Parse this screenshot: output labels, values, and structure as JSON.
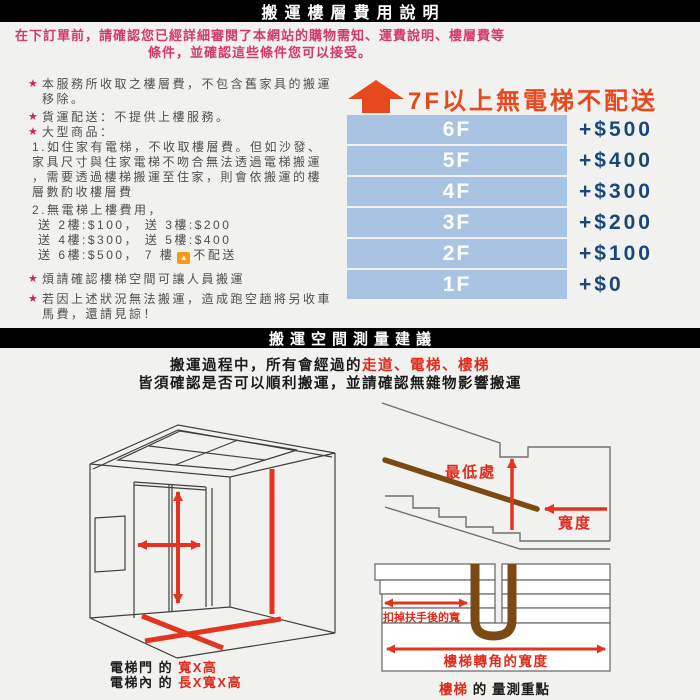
{
  "section1": {
    "header": "搬運樓層費用說明",
    "intro_line1": "在下訂單前，請確認您已經詳細審閱了本網站的購物需知、運費說明、樓層費等",
    "intro_line2": "條件，並確認這些條件您可以接受。",
    "bullet1": "本服務所收取之樓層費，不包含舊家具的搬運移除。",
    "bullet2": "貨運配送：不提供上樓服務。",
    "bullet3": "大型商品：",
    "bullet3_detail_lines": [
      "1.如住家有電梯，不收取樓層費。但如沙發、",
      "家具尺寸與住家電梯不吻合無法透過電梯搬運",
      "，需要透過樓梯搬運至住家，則會依搬運的樓",
      "層數酌收樓層費"
    ],
    "bullet3_detail2": "2.無電梯上樓費用，",
    "fee_line1": "送 2樓:$100， 送 3樓:$200",
    "fee_line2": "送 4樓:$300， 送 5樓:$400",
    "fee_line3_pre": "送 6樓:$500， 7 樓",
    "fee_line3_post": "不配送",
    "bullet4": "煩請確認樓梯空間可讓人員搬運",
    "bullet5": "若因上述狀況無法搬運，造成跑空趟將另收車馬費，還請見諒！",
    "warning": "7F以上無電梯不配送",
    "floors": [
      {
        "label": "6F",
        "fee": "+$500"
      },
      {
        "label": "5F",
        "fee": "+$400"
      },
      {
        "label": "4F",
        "fee": "+$300"
      },
      {
        "label": "3F",
        "fee": "+$200"
      },
      {
        "label": "2F",
        "fee": "+$100"
      },
      {
        "label": "1F",
        "fee": "+$0"
      }
    ]
  },
  "section2": {
    "header": "搬運空間測量建議",
    "intro_line1_black": "搬運過程中，所有會經過的",
    "intro_line1_red": "走道、電梯、樓梯",
    "intro_line2": "皆須確認是否可以順利搬運，並請確認無雜物影響搬運",
    "elevator_caption": {
      "cap1_black": "電梯門 的",
      "cap1_red": "寬X高",
      "cap2_black": "電梯內 的",
      "cap2_red": "長X寬X高"
    },
    "stairs_labels": {
      "lowest": "最低處",
      "width": "寬度"
    },
    "corner_labels": {
      "handrail_width": "扣掉扶手後的寬",
      "corner_width": "樓梯轉角的寬度",
      "cap_red": "樓梯",
      "cap_black": "的 量測重點"
    }
  },
  "colors": {
    "pink": "#d23a6a",
    "orange": "#e8481d",
    "amber": "#f59a18",
    "bar_blue": "#a9c4e3",
    "navy": "#1b4679",
    "text_gray": "#4f4f4f",
    "diagram_red": "#e02a1c",
    "rail_brown": "#7a4a12"
  }
}
